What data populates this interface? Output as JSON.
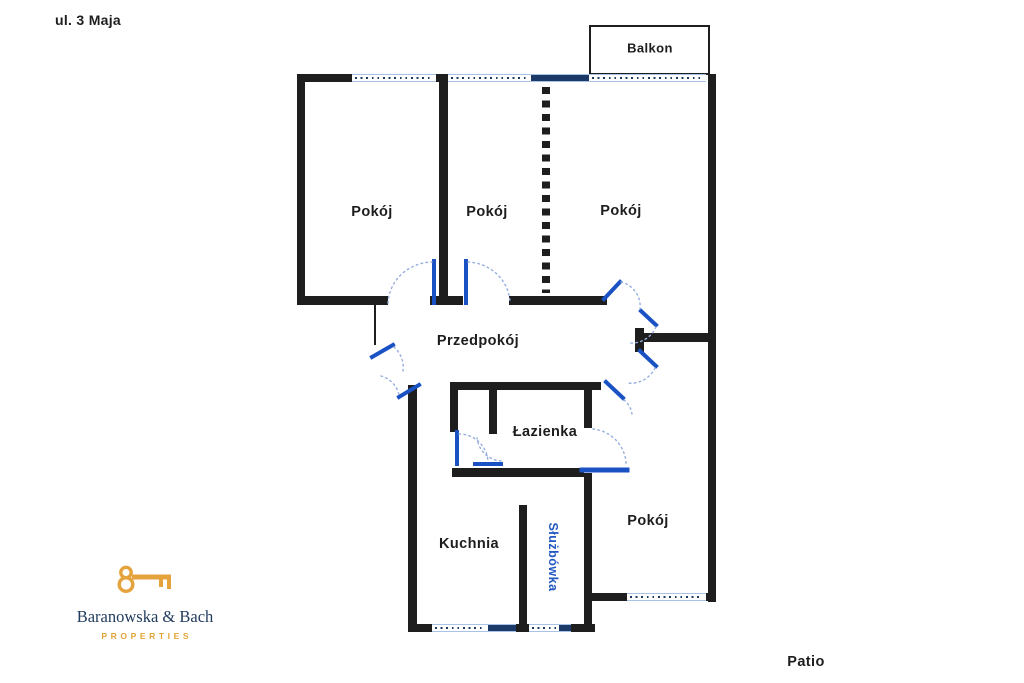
{
  "street_label": "ul. 3 Maja",
  "patio_label": "Patio",
  "rooms": {
    "balcony": "Balkon",
    "room_top_left": "Pokój",
    "room_top_middle": "Pokój",
    "room_top_right": "Pokój",
    "hallway": "Przedpokój",
    "bathroom": "Łazienka",
    "kitchen": "Kuchnia",
    "maids_room": "Służbówka",
    "room_bottom_right": "Pokój"
  },
  "logo": {
    "name": "Baranowska & Bach",
    "tagline": "PROPERTIES"
  },
  "colors": {
    "wall": "#1e1e1e",
    "door_leaf": "#1a52c4",
    "door_arc": "#96aede",
    "window_edge": "#a9c3e6",
    "window_dot": "#1c3a68",
    "label_text": "#1d1d1d",
    "maids_room_text": "#2057c0",
    "logo_gold": "#e5a33d",
    "logo_navy": "#223c5e"
  }
}
